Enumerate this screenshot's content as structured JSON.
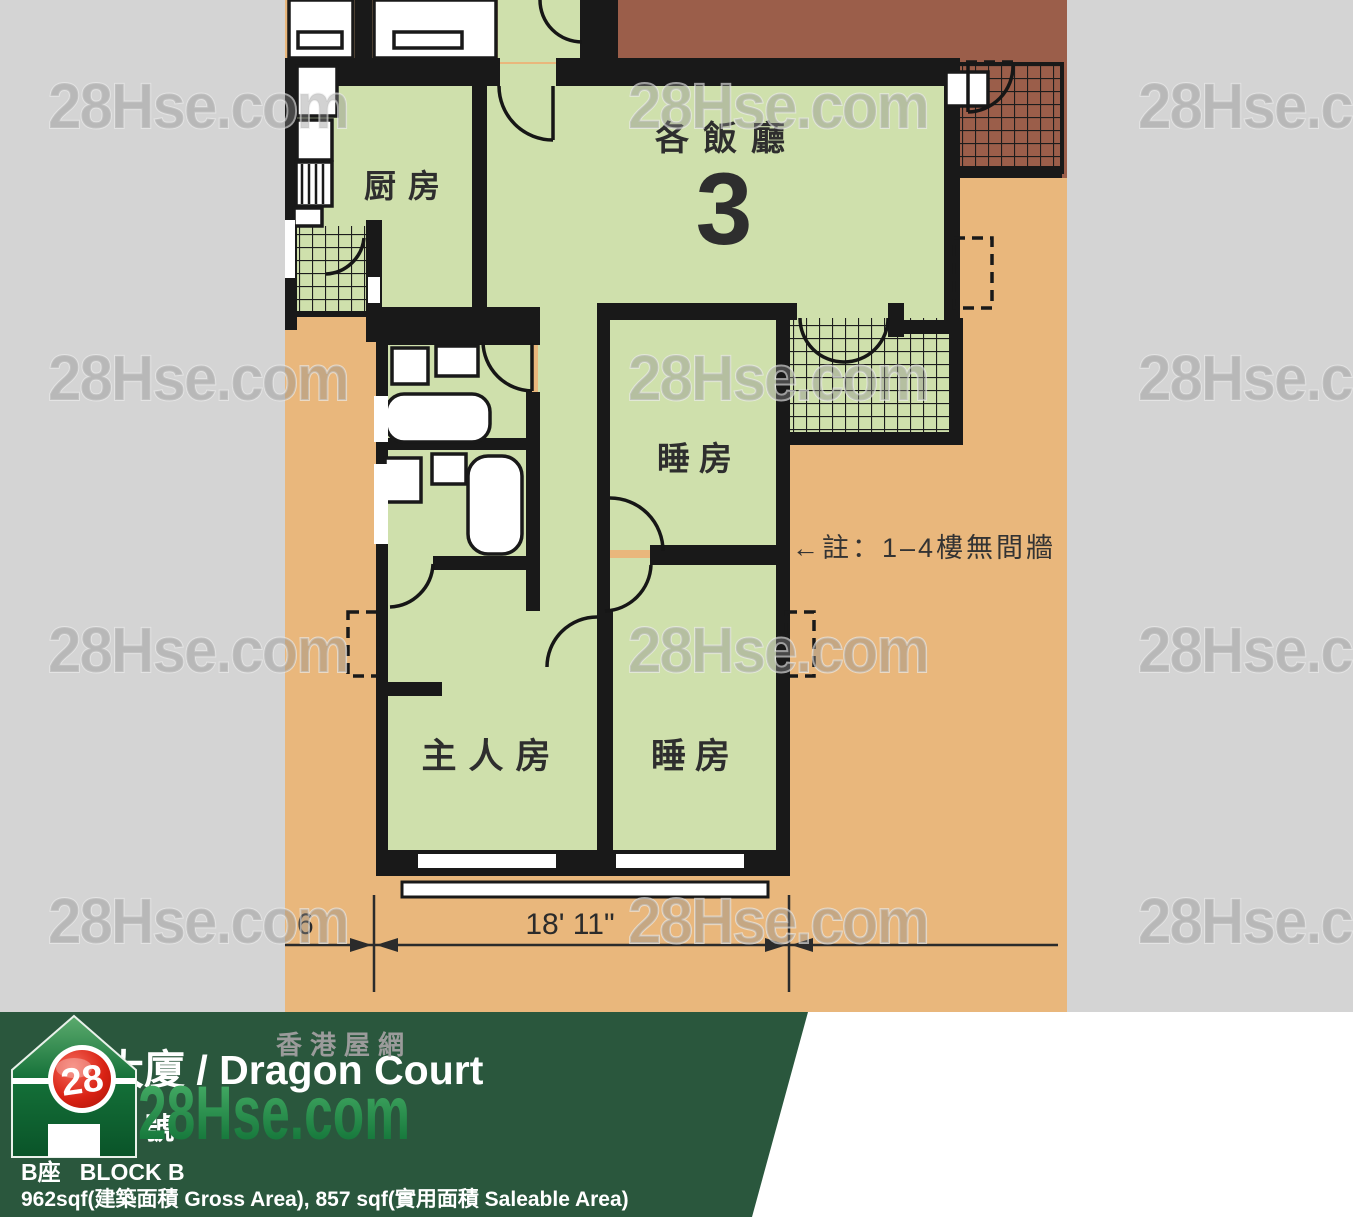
{
  "image": {
    "watermark": "28Hse.com"
  },
  "floorplan": {
    "labels": {
      "kitchen": "厨房",
      "living_dining": "各飯廳",
      "living_unit_number": "3",
      "bedroom_top": "睡房",
      "master_bedroom": "主人房",
      "bedroom_bottom": "睡房"
    },
    "note": "←註：1–4樓無間牆",
    "dimension": {
      "width_label": "18' 11\"",
      "left_partial": "6"
    }
  },
  "banner": {
    "title": "金龍大廈 / Dragon Court",
    "address": "金龍臺 6 號",
    "block": "B座   BLOCK B",
    "areas": "962sqf(建築面積 Gross Area), 857 sqf(實用面積 Saleable Area)"
  },
  "logo": {
    "badge": "28",
    "brand": "28Hse.com",
    "tagline": "香港屋網"
  },
  "colors": {
    "photo_bg": "#e9b77c",
    "room_fill": "#cfe0ac",
    "neighbor_brown": "#9b5e4a",
    "margin_gray": "#d4d4d4",
    "banner_green": "#2a573d",
    "logo_red": "#d21f12",
    "logo_green": "#0f7c3a",
    "wall_black": "#191919"
  }
}
